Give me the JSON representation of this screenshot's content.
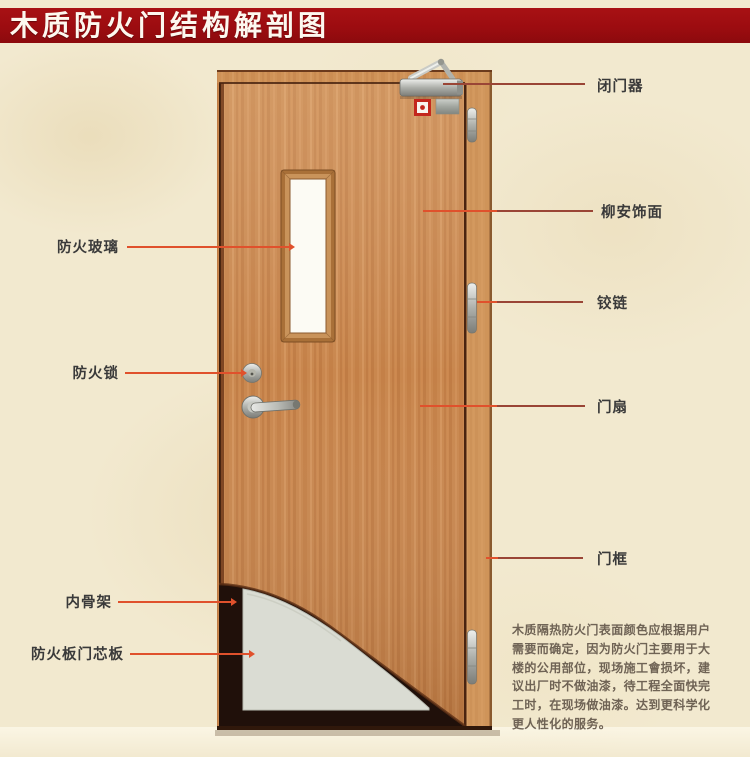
{
  "title": "木质防火门结构解剖图",
  "right_labels": {
    "door_closer": "闭门器",
    "veneer": "柳安饰面",
    "hinge": "铰链",
    "door_leaf": "门扇",
    "door_frame": "门框"
  },
  "left_labels": {
    "fire_glass": "防火玻璃",
    "fire_lock": "防火锁",
    "inner_skeleton": "内骨架",
    "fire_board_core": "防火板门芯板"
  },
  "description": {
    "lines": [
      "木质隔热防火门表面颜色应根据用户",
      "需要而确定，因为防火门主要用于大",
      "楼的公用部位，现场施工會损坏，建",
      "议出厂时不做油漆，待工程全面快完",
      "工时，在现场做油漆。达到更科学化",
      "更人性化的服务。"
    ]
  },
  "colors": {
    "title_bar": "#9c0c10",
    "leader_bright": "#e0512c",
    "leader_muted": "#9a4536",
    "door_wood": "#c9874e",
    "core_gray": "#dadcd3",
    "background": "#f2e9cf"
  }
}
